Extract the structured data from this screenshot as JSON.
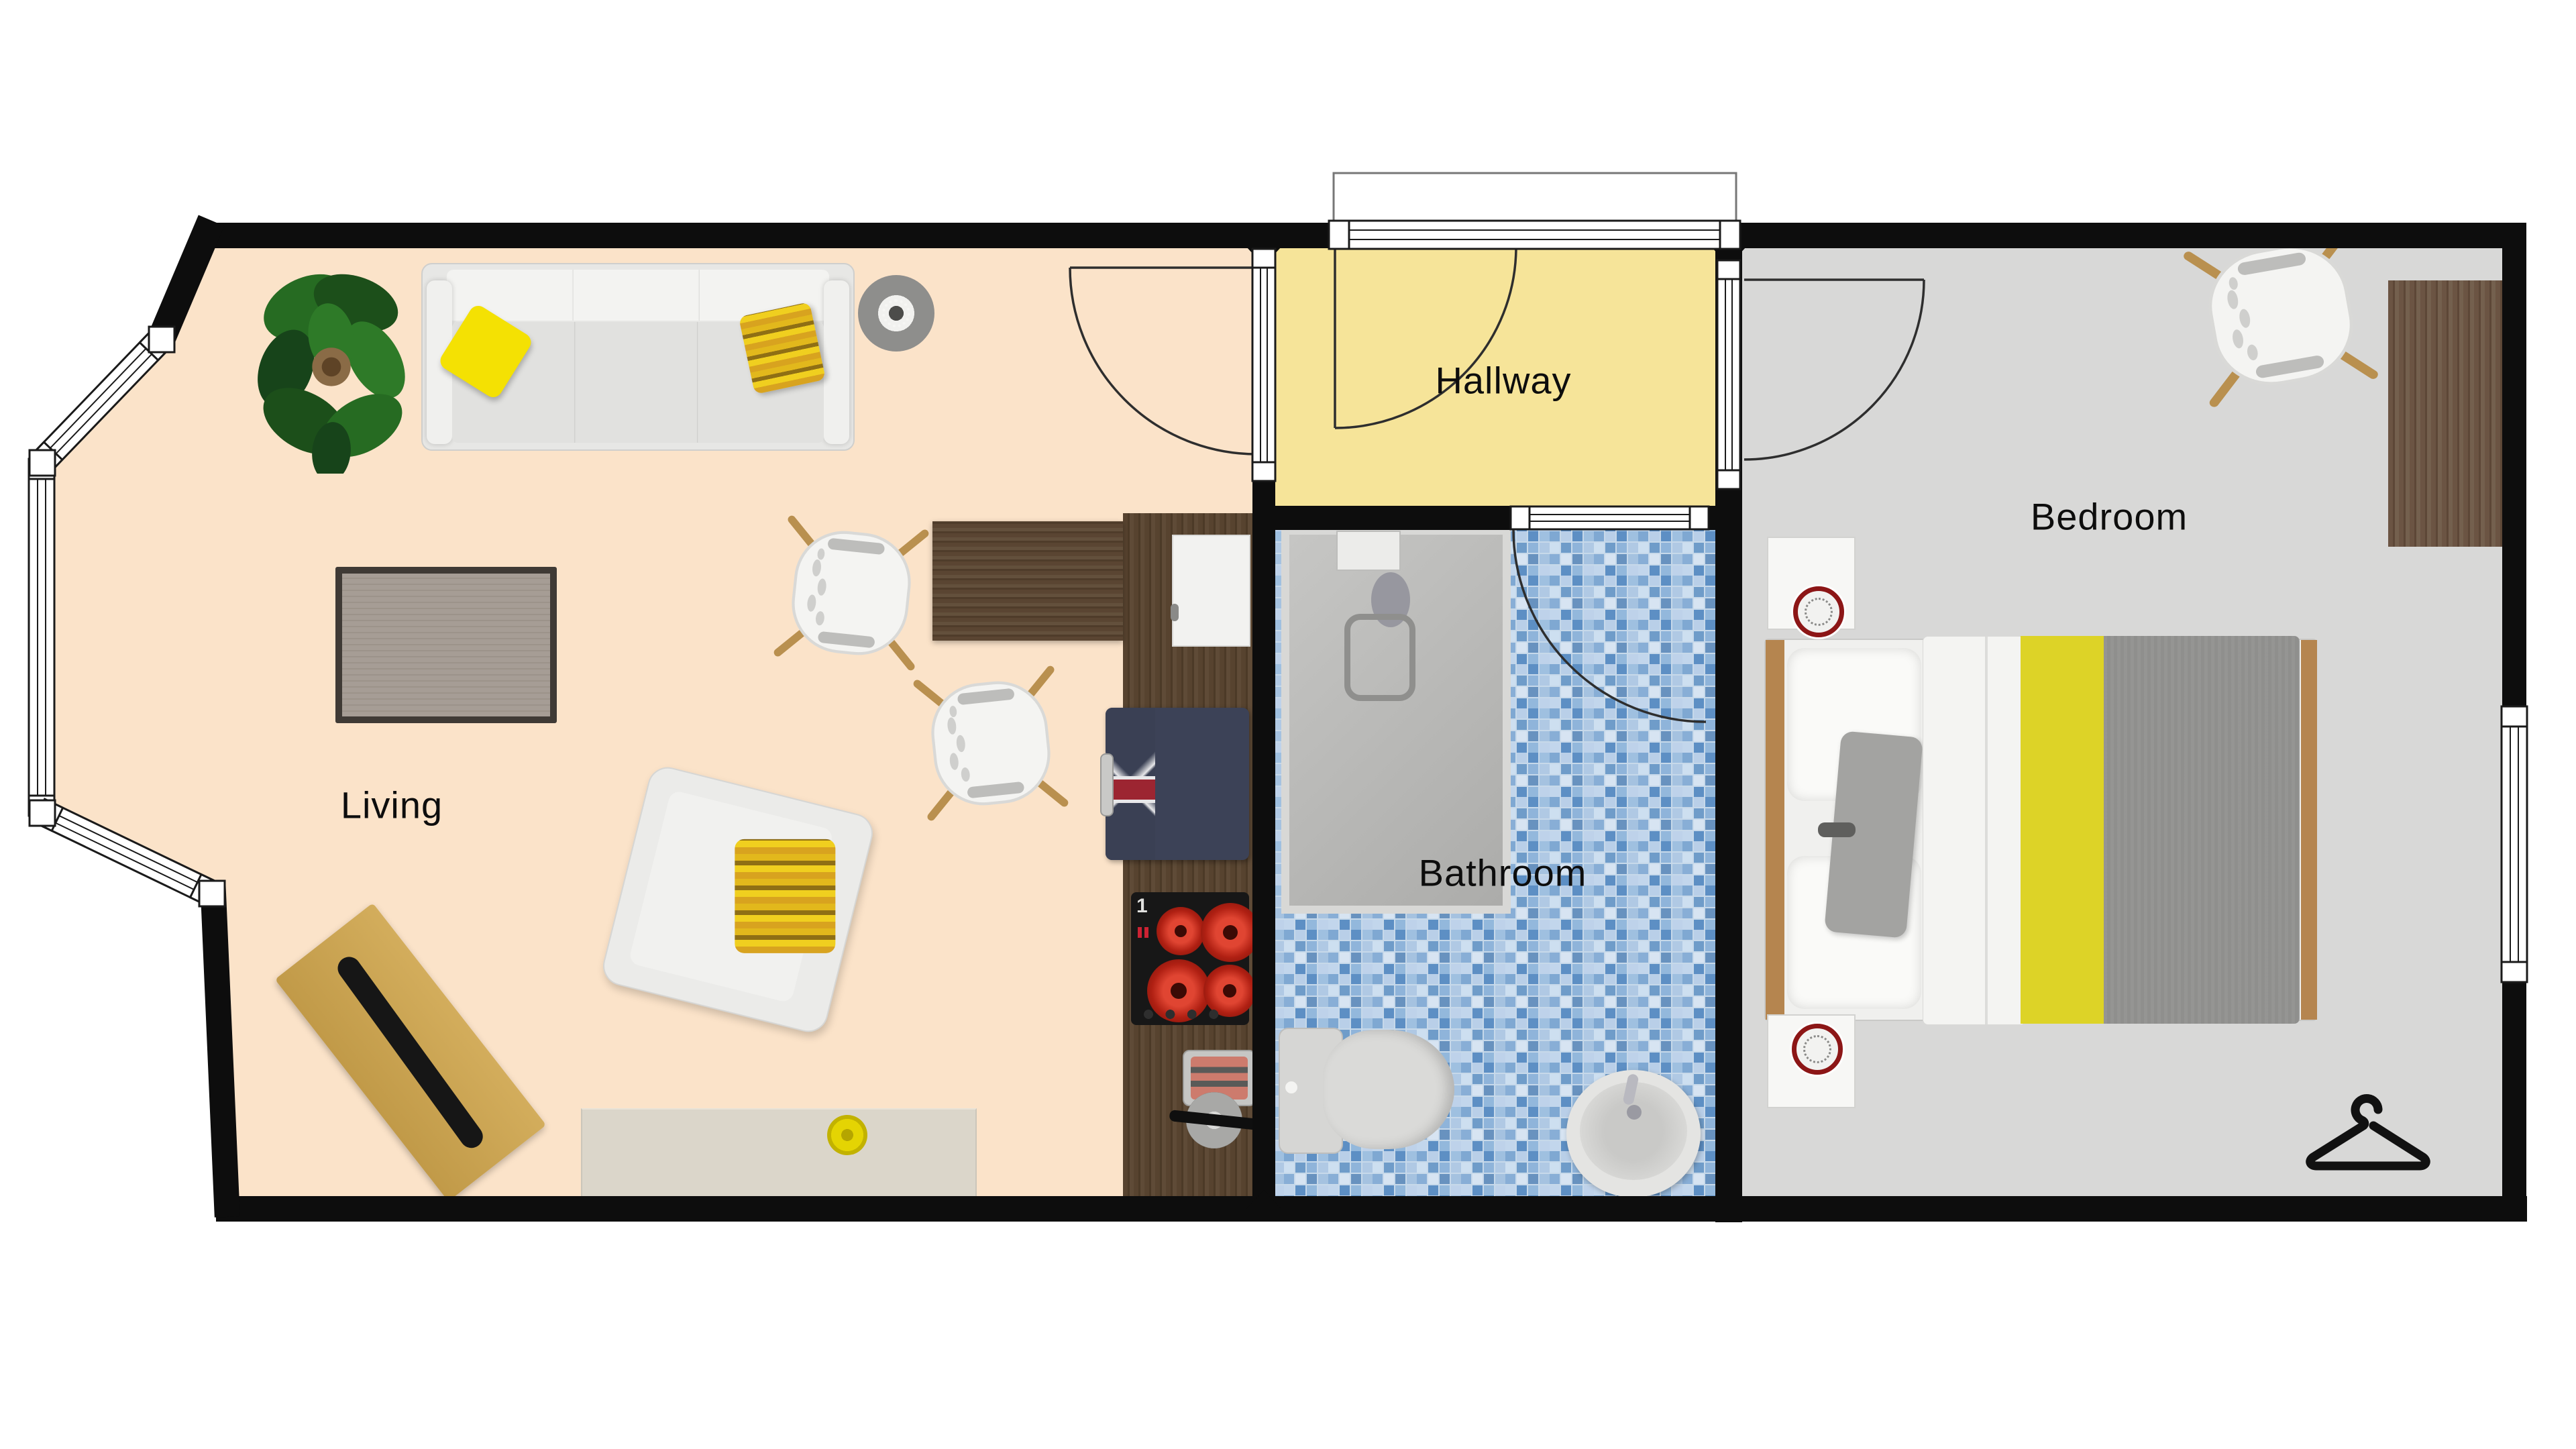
{
  "floorplan": {
    "rooms": [
      {
        "id": "living",
        "label": "Living",
        "floor_color": "#fbe3c9"
      },
      {
        "id": "hallway",
        "label": "Hallway",
        "floor_color": "#f6e499"
      },
      {
        "id": "bathroom",
        "label": "Bathroom",
        "floor_color": "#c7d9ea"
      },
      {
        "id": "bedroom",
        "label": "Bedroom",
        "floor_color": "#d8d8d7"
      }
    ],
    "wall_color": "#0d0d0d",
    "window_frame_color": "#1a1a1a",
    "kitchen": {
      "cooktop_marker": "1"
    },
    "accent_colors": {
      "pillow_yellow": "#f4e103",
      "bed_stripe_yellow": "#ddd327",
      "burner_red": "#c52a18",
      "clock_ring_red": "#8c1616",
      "appliance_navy": "#3c4257",
      "counter_wood": "#57432f",
      "tile_blue": "#6f9cc9"
    },
    "icons": {
      "hanger_icon": "clothes-hanger",
      "plant_icon": "potted-plant",
      "fan_icon": "ceiling-lamp"
    }
  }
}
